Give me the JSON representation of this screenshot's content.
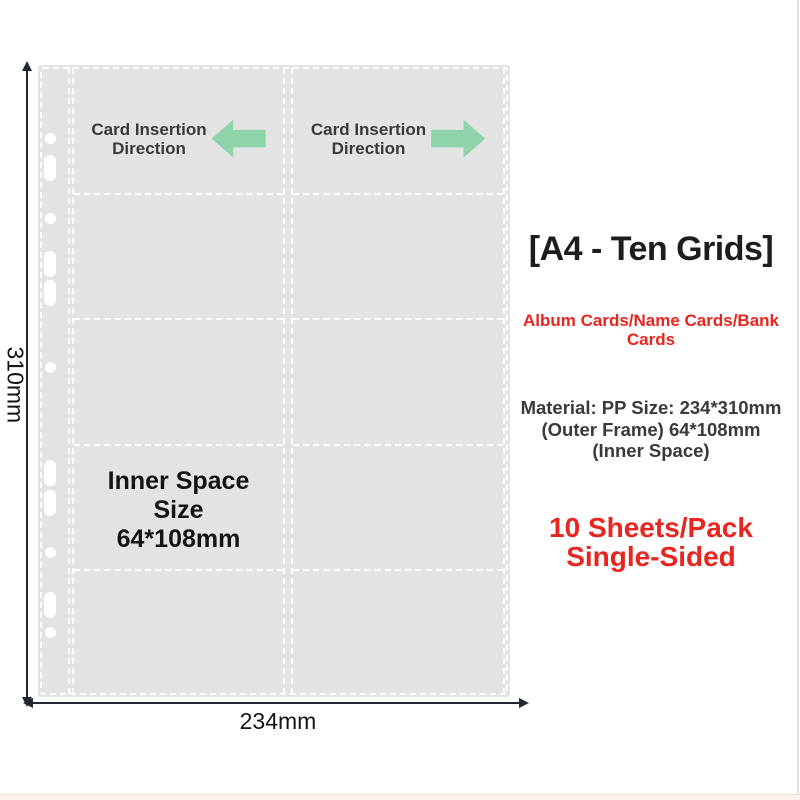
{
  "product_diagram": {
    "sleeve": {
      "fill_color": "#e3e3e3",
      "dash_color": "#ffffff",
      "grid": {
        "rows": 5,
        "columns": 2,
        "pockets": 10
      },
      "insertion_left": {
        "line1": "Card Insertion",
        "line2": "Direction",
        "arrow_direction": "left"
      },
      "insertion_right": {
        "line1": "Card Insertion",
        "line2": "Direction",
        "arrow_direction": "right"
      },
      "arrow_color": "#8fd3ab",
      "inner_space": {
        "line1": "Inner Space",
        "line2": "Size",
        "line3": "64*108mm"
      },
      "holes": [
        {
          "type": "circle",
          "y": 73
        },
        {
          "type": "slot",
          "y": 103
        },
        {
          "type": "circle",
          "y": 153
        },
        {
          "type": "slot",
          "y": 199
        },
        {
          "type": "slot",
          "y": 228
        },
        {
          "type": "circle",
          "y": 302
        },
        {
          "type": "slot",
          "y": 408
        },
        {
          "type": "slot",
          "y": 438
        },
        {
          "type": "circle",
          "y": 487
        },
        {
          "type": "slot",
          "y": 540
        },
        {
          "type": "circle",
          "y": 567
        }
      ]
    },
    "dimensions": {
      "height_label": "310mm",
      "width_label": "234mm",
      "line_color": "#232733"
    }
  },
  "info_panel": {
    "title": "[A4 - Ten Grids]",
    "title_color": "#1e1c1c",
    "subtitle": {
      "line1": "Album Cards/Name Cards/Bank",
      "line2": "Cards",
      "color": "#e8251f"
    },
    "material": {
      "line1": "Material: PP Size: 234*310mm",
      "line2": "(Outer Frame) 64*108mm",
      "line3": "(Inner Space)",
      "color": "#3a3a3a"
    },
    "pack": {
      "line1": "10 Sheets/Pack",
      "line2": "Single-Sided",
      "color": "#e8251f"
    }
  }
}
